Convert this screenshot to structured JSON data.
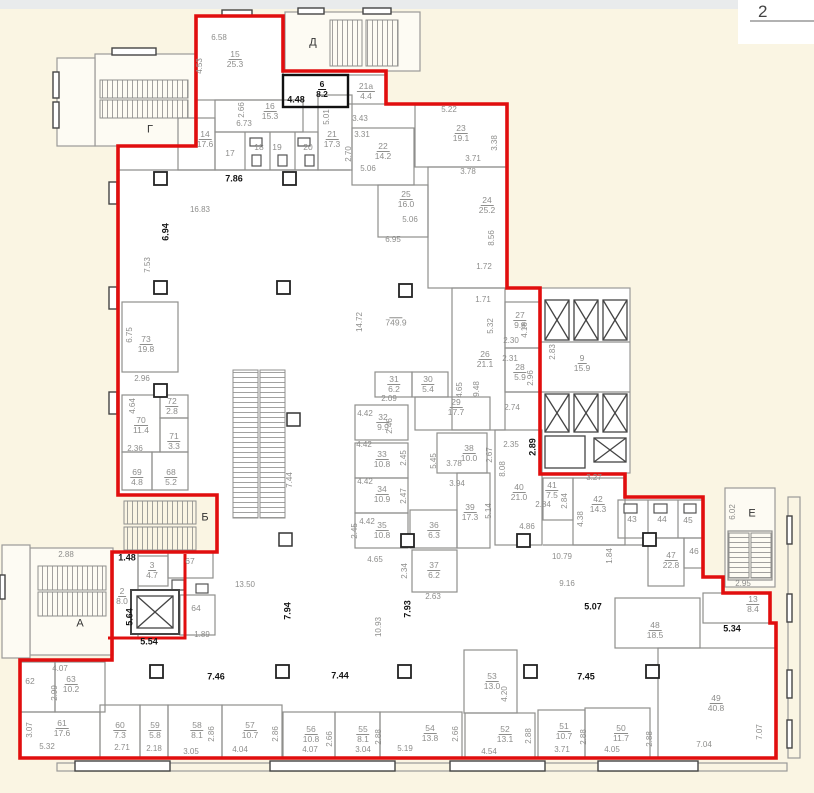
{
  "page": {
    "number": "2",
    "background": "#faf5e3",
    "boundary_color": "#e10e0e",
    "wall_color": "#8f8f8d"
  },
  "plan": {
    "letters": [
      {
        "t": "Г",
        "x": 150,
        "y": 130
      },
      {
        "t": "Д",
        "x": 313,
        "y": 43
      },
      {
        "t": "А",
        "x": 80,
        "y": 624
      },
      {
        "t": "Б",
        "x": 205,
        "y": 518
      },
      {
        "t": "Е",
        "x": 752,
        "y": 514
      }
    ],
    "rooms": [
      {
        "n": "15",
        "a": "25.3",
        "x": 235,
        "y": 59
      },
      {
        "n": "16",
        "a": "15.3",
        "x": 270,
        "y": 111
      },
      {
        "n": "14",
        "a": "17.6",
        "x": 205,
        "y": 139
      },
      {
        "n": "21",
        "a": "17.3",
        "x": 332,
        "y": 139
      },
      {
        "n": "22",
        "a": "14.2",
        "x": 383,
        "y": 151
      },
      {
        "n": "6",
        "a": "8.2",
        "x": 322,
        "y": 89,
        "b": 1
      },
      {
        "n": "21а",
        "a": "4.4",
        "x": 366,
        "y": 91
      },
      {
        "n": "23",
        "a": "19.1",
        "x": 461,
        "y": 133
      },
      {
        "n": "25",
        "a": "16.0",
        "x": 406,
        "y": 199
      },
      {
        "n": "24",
        "a": "25.2",
        "x": 487,
        "y": 205
      },
      {
        "n": "",
        "a": "749.9",
        "x": 396,
        "y": 322
      },
      {
        "n": "26",
        "a": "21.1",
        "x": 485,
        "y": 359
      },
      {
        "n": "27",
        "a": "9.8",
        "x": 520,
        "y": 320
      },
      {
        "n": "28",
        "a": "5.9",
        "x": 520,
        "y": 372
      },
      {
        "n": "9",
        "a": "15.9",
        "x": 582,
        "y": 363
      },
      {
        "n": "73",
        "a": "19.8",
        "x": 146,
        "y": 344
      },
      {
        "n": "70",
        "a": "11.4",
        "x": 141,
        "y": 425
      },
      {
        "n": "72",
        "a": "2.8",
        "x": 172,
        "y": 406
      },
      {
        "n": "71",
        "a": "3.3",
        "x": 174,
        "y": 441
      },
      {
        "n": "69",
        "a": "4.8",
        "x": 137,
        "y": 477
      },
      {
        "n": "68",
        "a": "5.2",
        "x": 171,
        "y": 477
      },
      {
        "n": "31",
        "a": "6.2",
        "x": 394,
        "y": 384
      },
      {
        "n": "30",
        "a": "5.4",
        "x": 428,
        "y": 384
      },
      {
        "n": "29",
        "a": "17.7",
        "x": 456,
        "y": 407
      },
      {
        "n": "32",
        "a": "9.9",
        "x": 383,
        "y": 422
      },
      {
        "n": "33",
        "a": "10.8",
        "x": 382,
        "y": 459
      },
      {
        "n": "34",
        "a": "10.9",
        "x": 382,
        "y": 494
      },
      {
        "n": "35",
        "a": "10.8",
        "x": 382,
        "y": 530
      },
      {
        "n": "36",
        "a": "6.3",
        "x": 434,
        "y": 530
      },
      {
        "n": "37",
        "a": "6.2",
        "x": 434,
        "y": 570
      },
      {
        "n": "38",
        "a": "10.0",
        "x": 469,
        "y": 453
      },
      {
        "n": "39",
        "a": "17.3",
        "x": 470,
        "y": 512
      },
      {
        "n": "40",
        "a": "21.0",
        "x": 519,
        "y": 492
      },
      {
        "n": "41",
        "a": "7.5",
        "x": 552,
        "y": 490
      },
      {
        "n": "42",
        "a": "14.3",
        "x": 598,
        "y": 504
      },
      {
        "n": "47",
        "a": "22.8",
        "x": 671,
        "y": 560
      },
      {
        "n": "48",
        "a": "18.5",
        "x": 655,
        "y": 630
      },
      {
        "n": "13",
        "a": "8.4",
        "x": 753,
        "y": 604
      },
      {
        "n": "49",
        "a": "40.8",
        "x": 716,
        "y": 703
      },
      {
        "n": "50",
        "a": "11.7",
        "x": 621,
        "y": 733
      },
      {
        "n": "51",
        "a": "10.7",
        "x": 564,
        "y": 731
      },
      {
        "n": "52",
        "a": "13.1",
        "x": 505,
        "y": 734
      },
      {
        "n": "53",
        "a": "13.0",
        "x": 492,
        "y": 681
      },
      {
        "n": "54",
        "a": "13.8",
        "x": 430,
        "y": 733
      },
      {
        "n": "55",
        "a": "8.1",
        "x": 363,
        "y": 734
      },
      {
        "n": "56",
        "a": "10.8",
        "x": 311,
        "y": 734
      },
      {
        "n": "57",
        "a": "10.7",
        "x": 250,
        "y": 730
      },
      {
        "n": "58",
        "a": "8.1",
        "x": 197,
        "y": 730
      },
      {
        "n": "59",
        "a": "5.8",
        "x": 155,
        "y": 730
      },
      {
        "n": "60",
        "a": "7.3",
        "x": 120,
        "y": 730
      },
      {
        "n": "61",
        "a": "17.6",
        "x": 62,
        "y": 728
      },
      {
        "n": "63",
        "a": "10.2",
        "x": 71,
        "y": 684
      },
      {
        "n": "2",
        "a": "8.0",
        "x": 122,
        "y": 596
      },
      {
        "n": "3",
        "a": "4.7",
        "x": 152,
        "y": 570
      }
    ],
    "plains": [
      {
        "t": "17",
        "x": 230,
        "y": 153
      },
      {
        "t": "18",
        "x": 259,
        "y": 147
      },
      {
        "t": "19",
        "x": 277,
        "y": 147
      },
      {
        "t": "20",
        "x": 308,
        "y": 147
      },
      {
        "t": "43",
        "x": 632,
        "y": 519
      },
      {
        "t": "44",
        "x": 662,
        "y": 519
      },
      {
        "t": "45",
        "x": 688,
        "y": 520
      },
      {
        "t": "46",
        "x": 694,
        "y": 551
      },
      {
        "t": "67",
        "x": 190,
        "y": 561
      },
      {
        "t": "64",
        "x": 196,
        "y": 608
      },
      {
        "t": "62",
        "x": 30,
        "y": 681
      }
    ],
    "dims": [
      {
        "t": "6.58",
        "x": 219,
        "y": 38
      },
      {
        "t": "4.53",
        "x": 200,
        "y": 66,
        "r": 1
      },
      {
        "t": "2.66",
        "x": 242,
        "y": 110,
        "r": 1
      },
      {
        "t": "6.73",
        "x": 244,
        "y": 124
      },
      {
        "t": "5.01",
        "x": 327,
        "y": 117,
        "r": 1
      },
      {
        "t": "3.43",
        "x": 360,
        "y": 119
      },
      {
        "t": "3.31",
        "x": 362,
        "y": 135
      },
      {
        "t": "2.70",
        "x": 349,
        "y": 154,
        "r": 1
      },
      {
        "t": "5.06",
        "x": 368,
        "y": 169
      },
      {
        "t": "4.48",
        "x": 296,
        "y": 100,
        "b": 1
      },
      {
        "t": "5.22",
        "x": 449,
        "y": 110
      },
      {
        "t": "3.38",
        "x": 495,
        "y": 143,
        "r": 1
      },
      {
        "t": "3.71",
        "x": 473,
        "y": 159
      },
      {
        "t": "3.78",
        "x": 468,
        "y": 172
      },
      {
        "t": "5.06",
        "x": 410,
        "y": 220
      },
      {
        "t": "6.95",
        "x": 393,
        "y": 240
      },
      {
        "t": "8.56",
        "x": 492,
        "y": 238,
        "r": 1
      },
      {
        "t": "1.72",
        "x": 484,
        "y": 267
      },
      {
        "t": "1.71",
        "x": 483,
        "y": 300
      },
      {
        "t": "5.32",
        "x": 491,
        "y": 326,
        "r": 1
      },
      {
        "t": "7.86",
        "x": 234,
        "y": 179,
        "b": 1
      },
      {
        "t": "16.83",
        "x": 200,
        "y": 210
      },
      {
        "t": "6.94",
        "x": 166,
        "y": 232,
        "r": 1,
        "b": 1
      },
      {
        "t": "7.53",
        "x": 148,
        "y": 265,
        "r": 1
      },
      {
        "t": "6.75",
        "x": 130,
        "y": 335,
        "r": 1
      },
      {
        "t": "2.96",
        "x": 142,
        "y": 379
      },
      {
        "t": "4.64",
        "x": 133,
        "y": 406,
        "r": 1
      },
      {
        "t": "2.36",
        "x": 135,
        "y": 449
      },
      {
        "t": "14.72",
        "x": 360,
        "y": 322,
        "r": 1
      },
      {
        "t": "2.83",
        "x": 553,
        "y": 352,
        "r": 1
      },
      {
        "t": "2.30",
        "x": 511,
        "y": 341
      },
      {
        "t": "4.16",
        "x": 525,
        "y": 330,
        "r": 1
      },
      {
        "t": "2.31",
        "x": 510,
        "y": 359
      },
      {
        "t": "2.96",
        "x": 531,
        "y": 378,
        "r": 1
      },
      {
        "t": "2.74",
        "x": 512,
        "y": 408
      },
      {
        "t": "2.35",
        "x": 511,
        "y": 445
      },
      {
        "t": "2.89",
        "x": 533,
        "y": 447,
        "r": 1,
        "b": 1
      },
      {
        "t": "8.08",
        "x": 503,
        "y": 469,
        "r": 1
      },
      {
        "t": "3.27",
        "x": 594,
        "y": 478
      },
      {
        "t": "2.84",
        "x": 543,
        "y": 505
      },
      {
        "t": "2.84",
        "x": 565,
        "y": 501,
        "r": 1
      },
      {
        "t": "4.38",
        "x": 581,
        "y": 519,
        "r": 1
      },
      {
        "t": "10.79",
        "x": 562,
        "y": 557
      },
      {
        "t": "1.84",
        "x": 610,
        "y": 556,
        "r": 1
      },
      {
        "t": "9.16",
        "x": 567,
        "y": 584
      },
      {
        "t": "4.86",
        "x": 527,
        "y": 527
      },
      {
        "t": "6.02",
        "x": 733,
        "y": 512,
        "r": 1
      },
      {
        "t": "2.95",
        "x": 743,
        "y": 584
      },
      {
        "t": "5.07",
        "x": 593,
        "y": 607,
        "b": 1
      },
      {
        "t": "5.34",
        "x": 732,
        "y": 629,
        "b": 1
      },
      {
        "t": "2.09",
        "x": 389,
        "y": 399
      },
      {
        "t": "4.42",
        "x": 365,
        "y": 414
      },
      {
        "t": "2.46",
        "x": 390,
        "y": 426,
        "r": 1
      },
      {
        "t": "4.42",
        "x": 364,
        "y": 445
      },
      {
        "t": "2.45",
        "x": 404,
        "y": 458,
        "r": 1
      },
      {
        "t": "4.42",
        "x": 365,
        "y": 482
      },
      {
        "t": "2.47",
        "x": 404,
        "y": 496,
        "r": 1
      },
      {
        "t": "4.42",
        "x": 367,
        "y": 522
      },
      {
        "t": "2.45",
        "x": 355,
        "y": 531,
        "r": 1
      },
      {
        "t": "5.45",
        "x": 434,
        "y": 461,
        "r": 1
      },
      {
        "t": "3.78",
        "x": 454,
        "y": 464
      },
      {
        "t": "2.67",
        "x": 490,
        "y": 455,
        "r": 1
      },
      {
        "t": "3.94",
        "x": 457,
        "y": 484
      },
      {
        "t": "5.14",
        "x": 489,
        "y": 511,
        "r": 1
      },
      {
        "t": "4.65",
        "x": 460,
        "y": 390,
        "r": 1
      },
      {
        "t": "9.48",
        "x": 477,
        "y": 389,
        "r": 1
      },
      {
        "t": "4.65",
        "x": 375,
        "y": 560
      },
      {
        "t": "2.34",
        "x": 405,
        "y": 571,
        "r": 1
      },
      {
        "t": "2.63",
        "x": 433,
        "y": 597
      },
      {
        "t": "7.93",
        "x": 408,
        "y": 609,
        "r": 1,
        "b": 1
      },
      {
        "t": "10.93",
        "x": 379,
        "y": 627,
        "r": 1
      },
      {
        "t": "7.94",
        "x": 288,
        "y": 611,
        "r": 1,
        "b": 1
      },
      {
        "t": "13.50",
        "x": 245,
        "y": 585
      },
      {
        "t": "7.44",
        "x": 290,
        "y": 480,
        "r": 1
      },
      {
        "t": "1.48",
        "x": 127,
        "y": 558,
        "b": 1
      },
      {
        "t": "5.64",
        "x": 130,
        "y": 617,
        "r": 1,
        "b": 1
      },
      {
        "t": "5.54",
        "x": 149,
        "y": 642,
        "b": 1
      },
      {
        "t": "2.88",
        "x": 66,
        "y": 555
      },
      {
        "t": "1.89",
        "x": 202,
        "y": 635
      },
      {
        "t": "4.07",
        "x": 60,
        "y": 669
      },
      {
        "t": "2.99",
        "x": 55,
        "y": 693,
        "r": 1
      },
      {
        "t": "3.07",
        "x": 30,
        "y": 730,
        "r": 1
      },
      {
        "t": "5.32",
        "x": 47,
        "y": 747
      },
      {
        "t": "2.71",
        "x": 122,
        "y": 748
      },
      {
        "t": "2.18",
        "x": 154,
        "y": 749
      },
      {
        "t": "3.05",
        "x": 191,
        "y": 752
      },
      {
        "t": "2.86",
        "x": 212,
        "y": 734,
        "r": 1
      },
      {
        "t": "4.04",
        "x": 240,
        "y": 750
      },
      {
        "t": "2.86",
        "x": 276,
        "y": 734,
        "r": 1
      },
      {
        "t": "7.46",
        "x": 216,
        "y": 677,
        "b": 1
      },
      {
        "t": "7.44",
        "x": 340,
        "y": 676,
        "b": 1
      },
      {
        "t": "4.07",
        "x": 310,
        "y": 750
      },
      {
        "t": "2.66",
        "x": 330,
        "y": 739,
        "r": 1
      },
      {
        "t": "3.04",
        "x": 363,
        "y": 750
      },
      {
        "t": "2.88",
        "x": 379,
        "y": 737,
        "r": 1
      },
      {
        "t": "5.19",
        "x": 405,
        "y": 749
      },
      {
        "t": "2.66",
        "x": 456,
        "y": 734,
        "r": 1
      },
      {
        "t": "4.54",
        "x": 489,
        "y": 752
      },
      {
        "t": "4.20",
        "x": 505,
        "y": 694,
        "r": 1
      },
      {
        "t": "2.88",
        "x": 529,
        "y": 736,
        "r": 1
      },
      {
        "t": "3.71",
        "x": 562,
        "y": 750
      },
      {
        "t": "2.88",
        "x": 584,
        "y": 737,
        "r": 1
      },
      {
        "t": "7.45",
        "x": 586,
        "y": 677,
        "b": 1
      },
      {
        "t": "4.05",
        "x": 612,
        "y": 750
      },
      {
        "t": "2.88",
        "x": 650,
        "y": 739,
        "r": 1
      },
      {
        "t": "7.04",
        "x": 704,
        "y": 745
      },
      {
        "t": "7.07",
        "x": 760,
        "y": 732,
        "r": 1
      }
    ]
  }
}
